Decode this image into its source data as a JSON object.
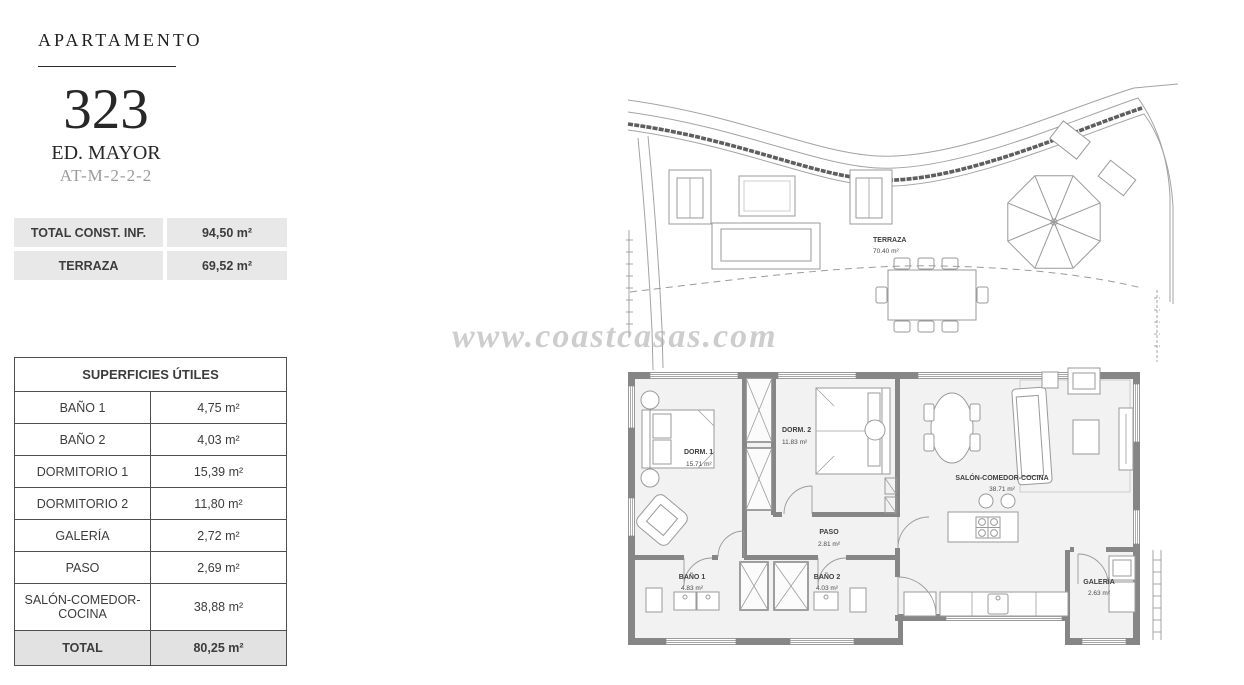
{
  "header": {
    "label": "APARTAMENTO",
    "number": "323",
    "building": "ED. MAYOR",
    "code": "AT-M-2-2-2"
  },
  "summary": {
    "rows": [
      {
        "label": "TOTAL CONST. INF.",
        "value": "94,50 m²"
      },
      {
        "label": "TERRAZA",
        "value": "69,52 m²"
      }
    ]
  },
  "surfaces": {
    "title": "SUPERFICIES ÚTILES",
    "rows": [
      {
        "label": "BAÑO 1",
        "value": "4,75 m²"
      },
      {
        "label": "BAÑO 2",
        "value": "4,03 m²"
      },
      {
        "label": "DORMITORIO 1",
        "value": "15,39 m²"
      },
      {
        "label": "DORMITORIO 2",
        "value": "11,80 m²"
      },
      {
        "label": "GALERÍA",
        "value": "2,72 m²"
      },
      {
        "label": "PASO",
        "value": "2,69 m²"
      },
      {
        "label": "SALÓN-COMEDOR-COCINA",
        "value": "38,88 m²"
      }
    ],
    "total": {
      "label": "TOTAL",
      "value": "80,25 m²"
    }
  },
  "watermark": {
    "text": "www.coastcasas.com"
  },
  "floorplan": {
    "terraza": {
      "name": "TERRAZA",
      "area": "70.40 m²"
    },
    "dorm1": {
      "name": "DORM. 1",
      "area": "15.71 m²"
    },
    "dorm2": {
      "name": "DORM. 2",
      "area": "11.83 m²"
    },
    "paso": {
      "name": "PASO",
      "area": "2.81 m²"
    },
    "salon": {
      "name": "SALÓN-COMEDOR-COCINA",
      "area": "38.71 m²"
    },
    "bano1": {
      "name": "BAÑO 1",
      "area": "4.83 m²"
    },
    "bano2": {
      "name": "BAÑO 2",
      "area": "4.03 m²"
    },
    "galeria": {
      "name": "GALERÍA",
      "area": "2.63 m²"
    }
  },
  "colors": {
    "wall": "#868686",
    "row_bg": "#e8e8e8",
    "total_bg": "#e2e2e2",
    "table_border": "#4f4f4f",
    "text": "#3e3e3e",
    "muted": "#9b9b9b",
    "watermark": "#a6a6a6"
  }
}
